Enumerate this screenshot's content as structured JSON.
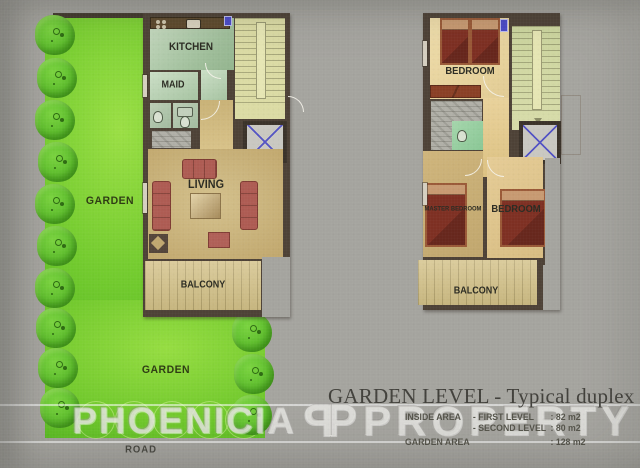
{
  "header": {
    "title": "GARDEN LEVEL - Typical duplex"
  },
  "areas": {
    "rows": [
      {
        "label": "INSIDE AREA",
        "level": "- FIRST LEVEL",
        "value": ": 82 m2"
      },
      {
        "label": "",
        "level": "- SECOND LEVEL",
        "value": ": 80 m2"
      },
      {
        "label": "GARDEN AREA",
        "level": "",
        "value": ": 128 m2"
      }
    ]
  },
  "watermark": {
    "word1": "PHOENICIA",
    "logo_mirrored": "P",
    "logo_plain": "P",
    "word2": "PROPERTY"
  },
  "site": {
    "garden_upper": "GARDEN",
    "garden_lower": "GARDEN",
    "road": "ROAD"
  },
  "plan_first": {
    "kitchen": "KITCHEN",
    "maid": "MAID",
    "living": "LIVING",
    "balcony": "BALCONY"
  },
  "plan_second": {
    "bedroom_top": "BEDROOM",
    "master": "MASTER BEDROOM",
    "bedroom": "BEDROOM",
    "balcony": "BALCONY"
  },
  "colors": {
    "background": "#A5A49F",
    "wall": "#4E4237",
    "garden_green": "#7ACF33",
    "living_tan": "#C6AE74",
    "bedroom_cream": "#E9D5A0",
    "bed_red": "#7E3023",
    "sofa_rose": "#AE5C53",
    "elevator_x_blue": "#5353C4",
    "stairs_yellow": "#DBDBA4"
  }
}
